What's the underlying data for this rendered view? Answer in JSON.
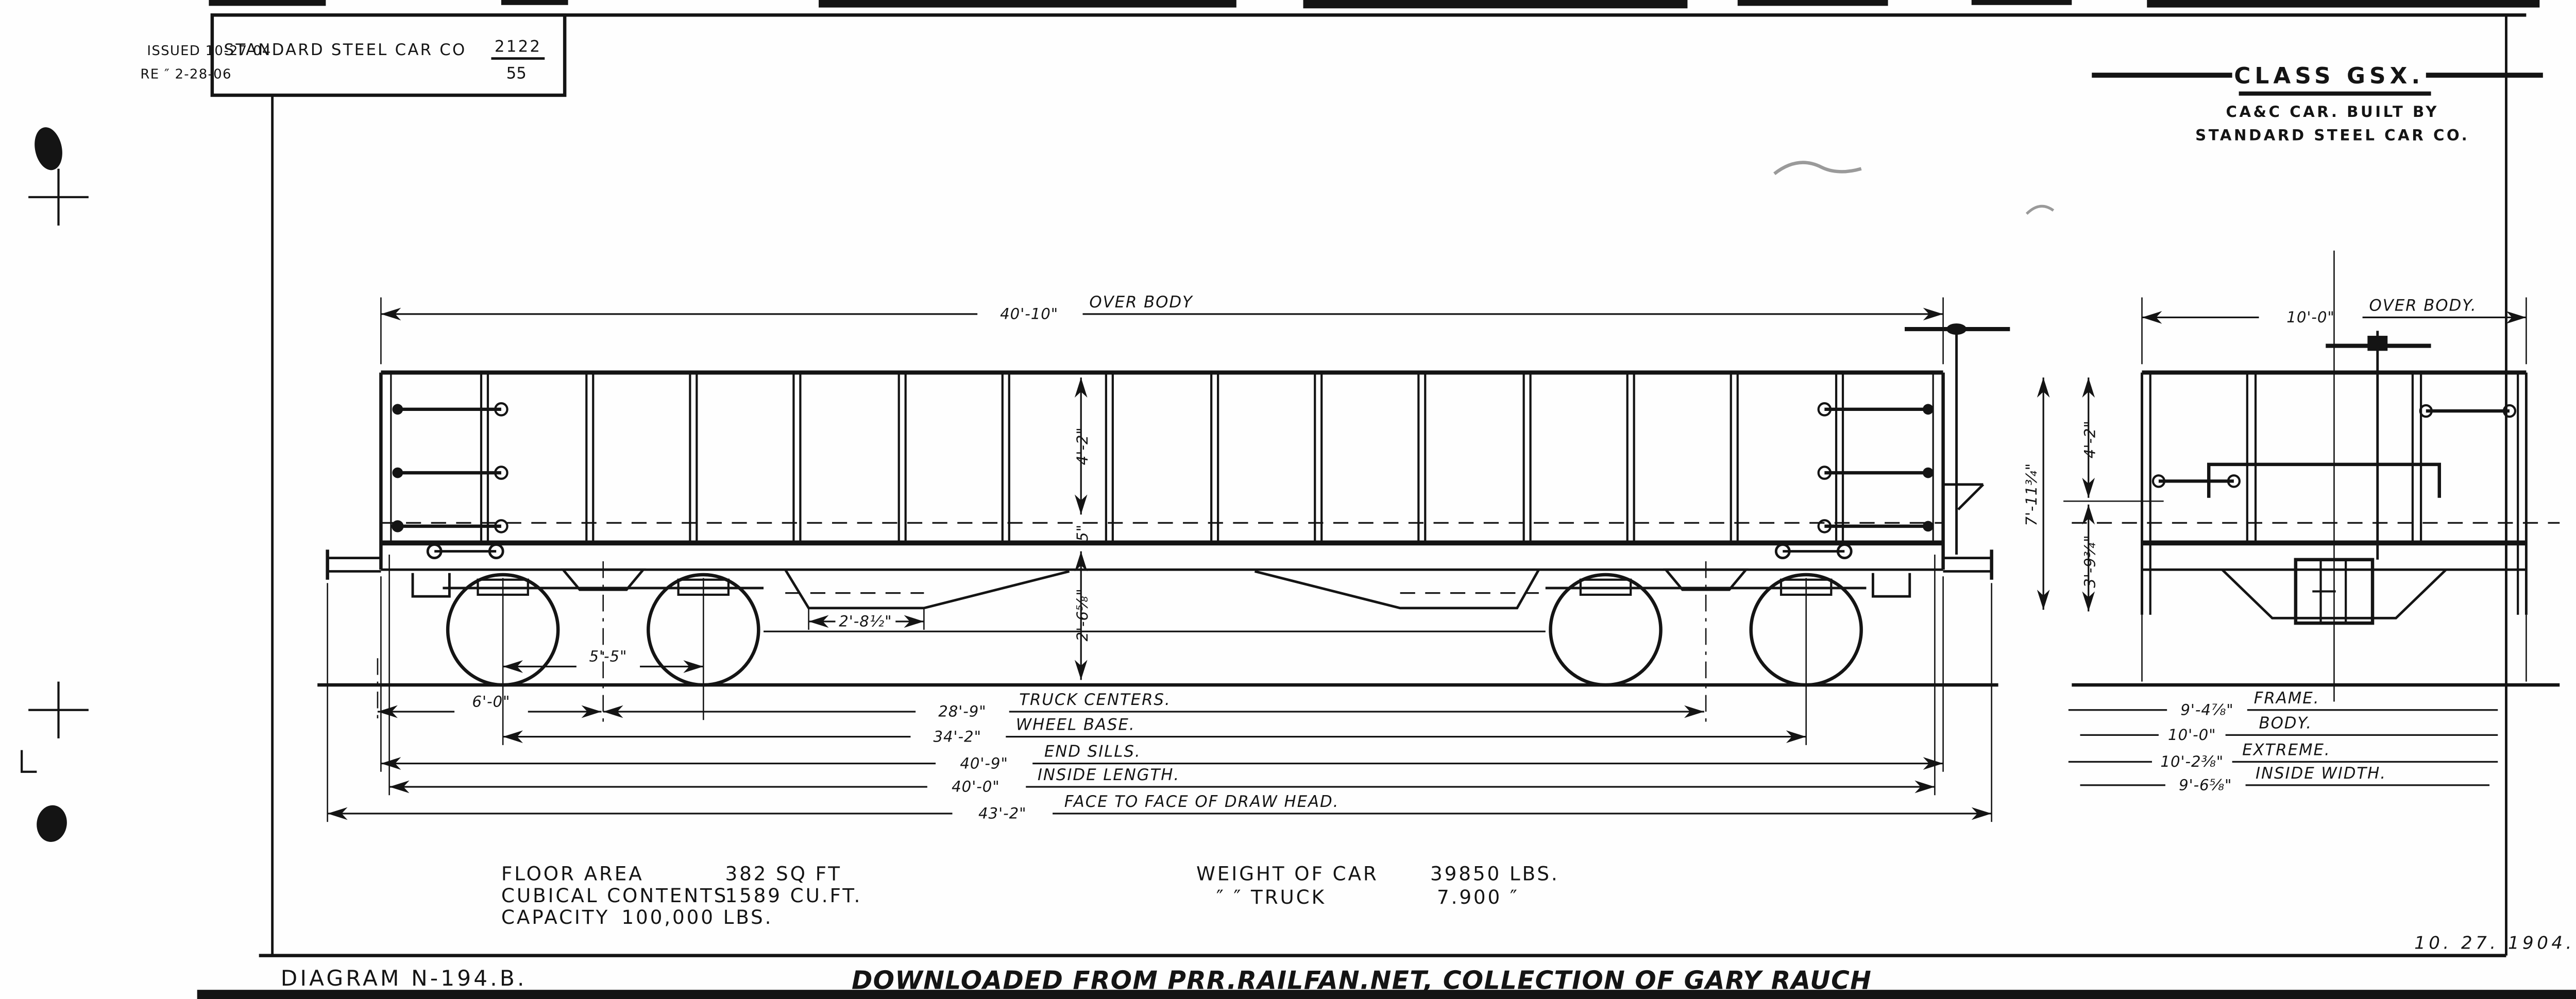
{
  "header": {
    "issued": "ISSUED 10-27-04",
    "revised": "RE  ″  2-28-06",
    "builder_name": "STANDARD STEEL CAR CO",
    "lot_number": "2122",
    "lot_denominator": "55"
  },
  "title_block": {
    "class_name": "CLASS GSX.",
    "built_by_1": "CA&C CAR. BUILT BY",
    "built_by_2": "STANDARD STEEL CAR CO."
  },
  "side_view": {
    "over_body_value": "40'-10\"",
    "over_body_label": "OVER BODY",
    "wheel_spacing": "5'-5\"",
    "end_to_truck": "6'-0\"",
    "truck_centers_value": "28'-9\"",
    "truck_centers_label": "TRUCK CENTERS.",
    "wheel_base_value": "34'-2\"",
    "wheel_base_label": "WHEEL BASE.",
    "end_sills_value": "40'-9\"",
    "end_sills_label": "END SILLS.",
    "inside_length_value": "40'-0\"",
    "inside_length_label": "INSIDE LENGTH.",
    "face_to_face_value": "43'-2\"",
    "face_to_face_label": "FACE TO FACE OF DRAW HEAD.",
    "hopper_width": "2'-8½\"",
    "height_floor_to_top": "4'-2\"",
    "floor_depth": "5\"",
    "sill_to_rail": "2'-6⅝\""
  },
  "end_view": {
    "over_body_value": "10'-0\"",
    "over_body_label": "OVER BODY.",
    "frame_value": "9'-4⅞\"",
    "frame_label": "FRAME.",
    "body_value": "10'-0\"",
    "body_label": "BODY.",
    "extreme_value": "10'-2⅜\"",
    "extreme_label": "EXTREME.",
    "inside_width_value": "9'-6⅝\"",
    "inside_width_label": "INSIDE WIDTH.",
    "total_height": "7'-11¾\"",
    "upper_height": "4'-2\"",
    "lower_height": "3'-9¾\""
  },
  "stats": {
    "floor_area_label": "FLOOR AREA",
    "floor_area_value": "382 SQ FT",
    "cubical_label": "CUBICAL CONTENTS",
    "cubical_value": "1589 CU.FT.",
    "capacity_label": "CAPACITY",
    "capacity_value": "100,000 LBS.",
    "weight_car_label": "WEIGHT OF CAR",
    "weight_car_value": "39850 LBS.",
    "weight_truck_label": "″        ″    TRUCK",
    "weight_truck_value": "7.900   ″"
  },
  "footer": {
    "diagram_number": "DIAGRAM N-194.B.",
    "watermark": "DOWNLOADED FROM PRR.RAILFAN.NET, COLLECTION OF GARY RAUCH",
    "date": "10. 27. 1904."
  },
  "colors": {
    "ink": "#141414",
    "paper": "#fefefe"
  }
}
